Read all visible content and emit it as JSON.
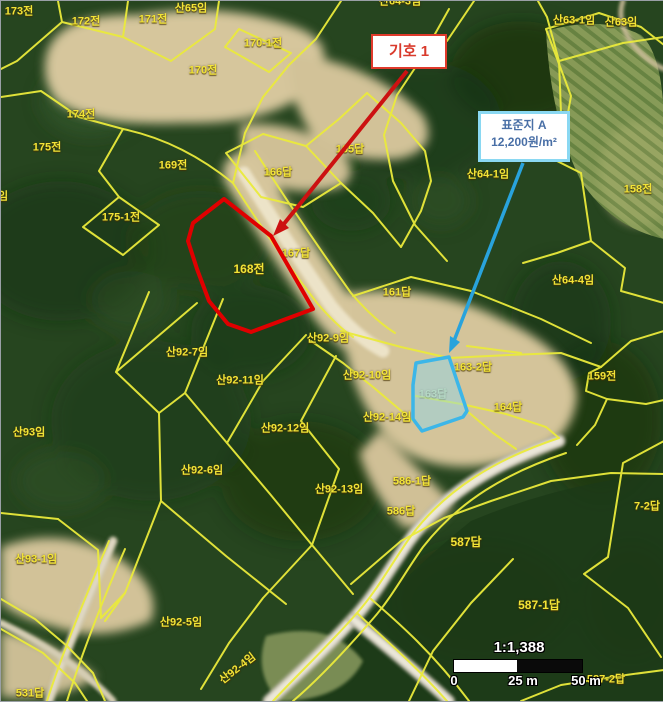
{
  "map": {
    "parcel_labels": [
      "173전",
      "산65임",
      "172전",
      "171전",
      "산64-3임",
      "산63-1임",
      "산63임",
      "170-1전",
      "170전",
      "174전",
      "175전",
      "169전",
      "166답",
      "165답",
      "산64-1임",
      "158전",
      "175-1전",
      "임",
      "168전",
      "167답",
      "161답",
      "산64-4임",
      "산92-9임",
      "산92-7임",
      "산92-11임",
      "산92-10임",
      "163-2답",
      "159전",
      "163답",
      "산92-14임",
      "164답",
      "산93임",
      "산92-12임",
      "산92-6임",
      "산92-13임",
      "586-1답",
      "7-2답",
      "586답",
      "587답",
      "산93-1임",
      "587-1답",
      "산92-5임",
      "산92-4임",
      "531답",
      "587-2답"
    ],
    "annotations": {
      "symbol_callout": {
        "label": "기호 1"
      },
      "standard_lot_callout": {
        "title": "표준지 A",
        "price": "12,200원/m²"
      }
    },
    "scale_bar": {
      "ratio": "1:1,388",
      "zero": "0",
      "mid": "25 m",
      "end": "50 m"
    },
    "colors": {
      "boundary_yellow": "#eaea3c",
      "label_yellow": "#f2e437",
      "symbol_red": "#d93a2c",
      "standard_blue": "#3cb6e8"
    }
  }
}
